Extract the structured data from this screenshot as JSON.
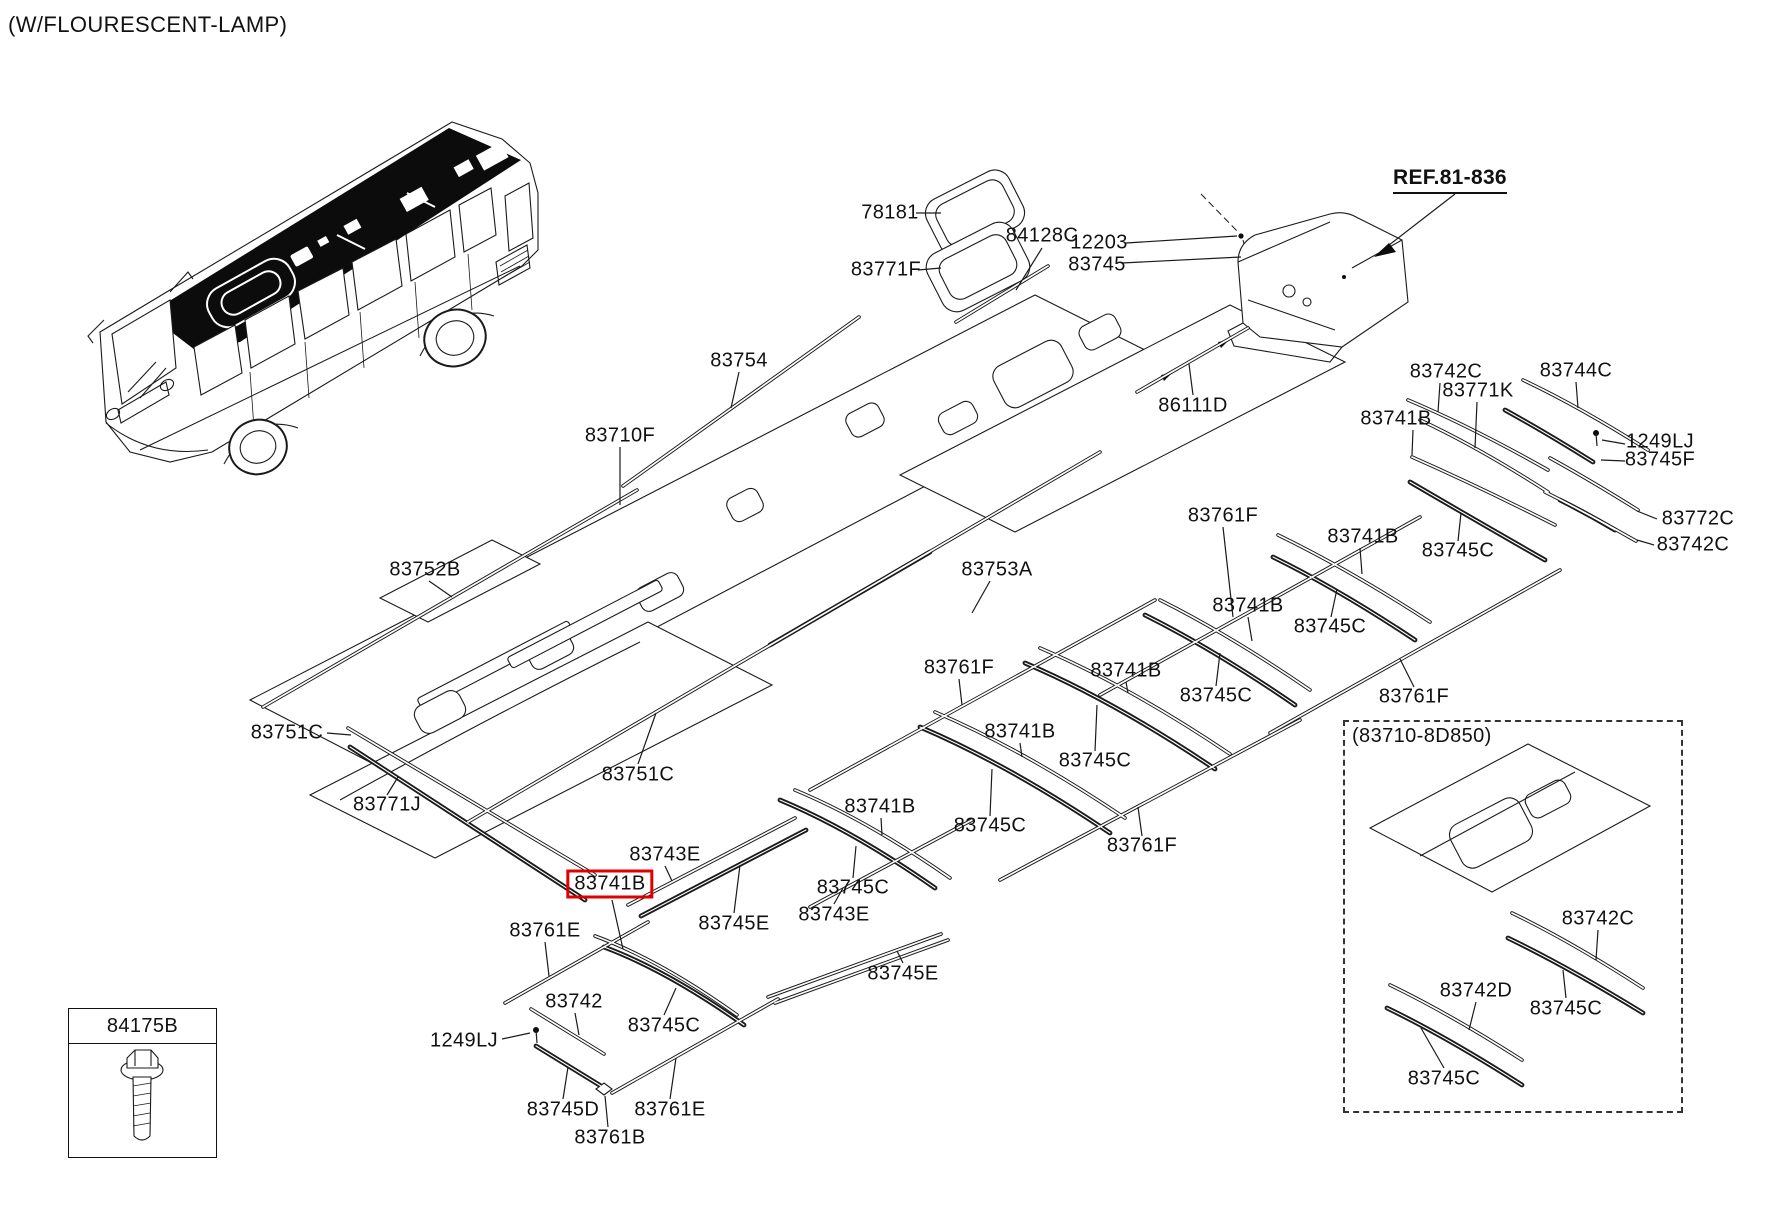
{
  "header": {
    "title": "(W/FLOURESCENT-LAMP)"
  },
  "ref_note": {
    "text": "REF.81-836"
  },
  "legend_box": {
    "part_no": "84175B",
    "icon": "bolt-screw-icon"
  },
  "dashed_box": {
    "title": "(83710-8D850)"
  },
  "canvas": {
    "width": 1772,
    "height": 1211,
    "line_color": "#1a1a1a",
    "highlight_color": "#e10000"
  },
  "part_labels": [
    {
      "text": "78181",
      "x": 890,
      "y": 213
    },
    {
      "text": "83771F",
      "x": 886,
      "y": 270
    },
    {
      "text": "84128C",
      "x": 1042,
      "y": 236
    },
    {
      "text": "12203",
      "x": 1099,
      "y": 243
    },
    {
      "text": "83745",
      "x": 1097,
      "y": 265
    },
    {
      "text": "83754",
      "x": 739,
      "y": 361
    },
    {
      "text": "86111D",
      "x": 1193,
      "y": 406
    },
    {
      "text": "83710F",
      "x": 620,
      "y": 436
    },
    {
      "text": "83752B",
      "x": 425,
      "y": 570
    },
    {
      "text": "83753A",
      "x": 997,
      "y": 570
    },
    {
      "text": "83751C",
      "x": 287,
      "y": 733
    },
    {
      "text": "83771J",
      "x": 387,
      "y": 805
    },
    {
      "text": "83751C",
      "x": 638,
      "y": 775
    },
    {
      "text": "83742C",
      "x": 1446,
      "y": 372
    },
    {
      "text": "83771K",
      "x": 1478,
      "y": 391
    },
    {
      "text": "83741B",
      "x": 1396,
      "y": 419
    },
    {
      "text": "83744C",
      "x": 1576,
      "y": 371
    },
    {
      "text": "1249LJ",
      "x": 1660,
      "y": 442
    },
    {
      "text": "83745F",
      "x": 1660,
      "y": 460
    },
    {
      "text": "83772C",
      "x": 1698,
      "y": 519
    },
    {
      "text": "83742C",
      "x": 1693,
      "y": 545
    },
    {
      "text": "83761F",
      "x": 1223,
      "y": 516
    },
    {
      "text": "83741B",
      "x": 1363,
      "y": 537
    },
    {
      "text": "83745C",
      "x": 1458,
      "y": 551
    },
    {
      "text": "83741B",
      "x": 1248,
      "y": 606
    },
    {
      "text": "83745C",
      "x": 1330,
      "y": 627
    },
    {
      "text": "83761F",
      "x": 959,
      "y": 668
    },
    {
      "text": "83741B",
      "x": 1126,
      "y": 671
    },
    {
      "text": "83745C",
      "x": 1216,
      "y": 696
    },
    {
      "text": "83741B",
      "x": 1020,
      "y": 732
    },
    {
      "text": "83745C",
      "x": 1095,
      "y": 761
    },
    {
      "text": "83761F",
      "x": 1414,
      "y": 697
    },
    {
      "text": "83761F",
      "x": 1142,
      "y": 846
    },
    {
      "text": "83741B",
      "x": 880,
      "y": 807
    },
    {
      "text": "83745C",
      "x": 853,
      "y": 888
    },
    {
      "text": "83745C",
      "x": 990,
      "y": 826
    },
    {
      "text": "83743E",
      "x": 665,
      "y": 855
    },
    {
      "text": "83741B",
      "x": 610,
      "y": 884,
      "highlighted": true
    },
    {
      "text": "83745E",
      "x": 734,
      "y": 924
    },
    {
      "text": "83743E",
      "x": 834,
      "y": 915
    },
    {
      "text": "83745E",
      "x": 903,
      "y": 974
    },
    {
      "text": "83761E",
      "x": 545,
      "y": 931
    },
    {
      "text": "83742",
      "x": 574,
      "y": 1002
    },
    {
      "text": "1249LJ",
      "x": 464,
      "y": 1041
    },
    {
      "text": "83745C",
      "x": 664,
      "y": 1026
    },
    {
      "text": "83745D",
      "x": 563,
      "y": 1110
    },
    {
      "text": "83761E",
      "x": 670,
      "y": 1110
    },
    {
      "text": "83761B",
      "x": 610,
      "y": 1138
    },
    {
      "text": "83742C",
      "x": 1598,
      "y": 919
    },
    {
      "text": "83745C",
      "x": 1566,
      "y": 1009
    },
    {
      "text": "83742D",
      "x": 1476,
      "y": 991
    },
    {
      "text": "83745C",
      "x": 1444,
      "y": 1079
    }
  ]
}
